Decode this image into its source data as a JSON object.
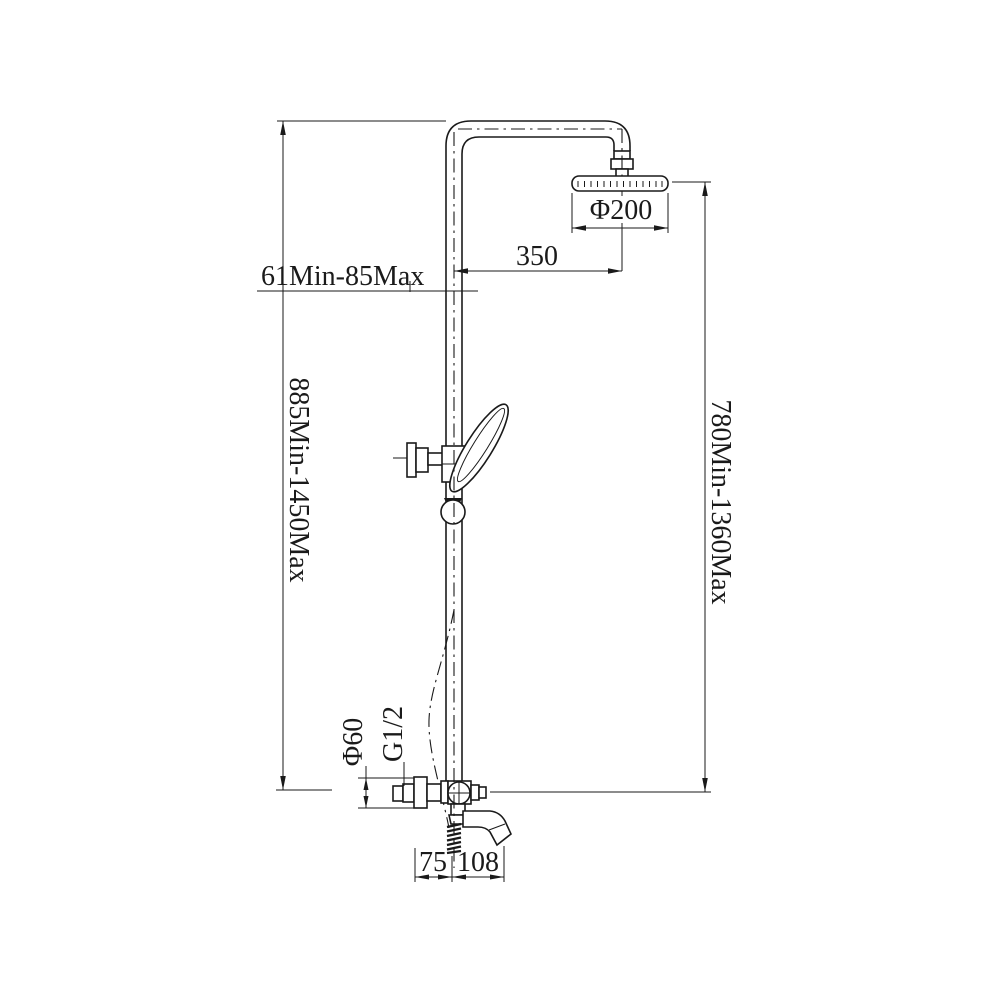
{
  "drawing": {
    "dimensions": {
      "head_diameter": "Φ200",
      "horizontal_offset": "350",
      "top_offset_range": "61Min-85Max",
      "total_height_range": "885Min-1450Max",
      "head_to_valve_range": "780Min-1360Max",
      "valve_body_diameter": "Φ60",
      "thread_size": "G1/2",
      "spout_dim_left": "75",
      "spout_dim_right": "108"
    },
    "colors": {
      "line": "#1a1a1a",
      "background": "#ffffff"
    }
  }
}
